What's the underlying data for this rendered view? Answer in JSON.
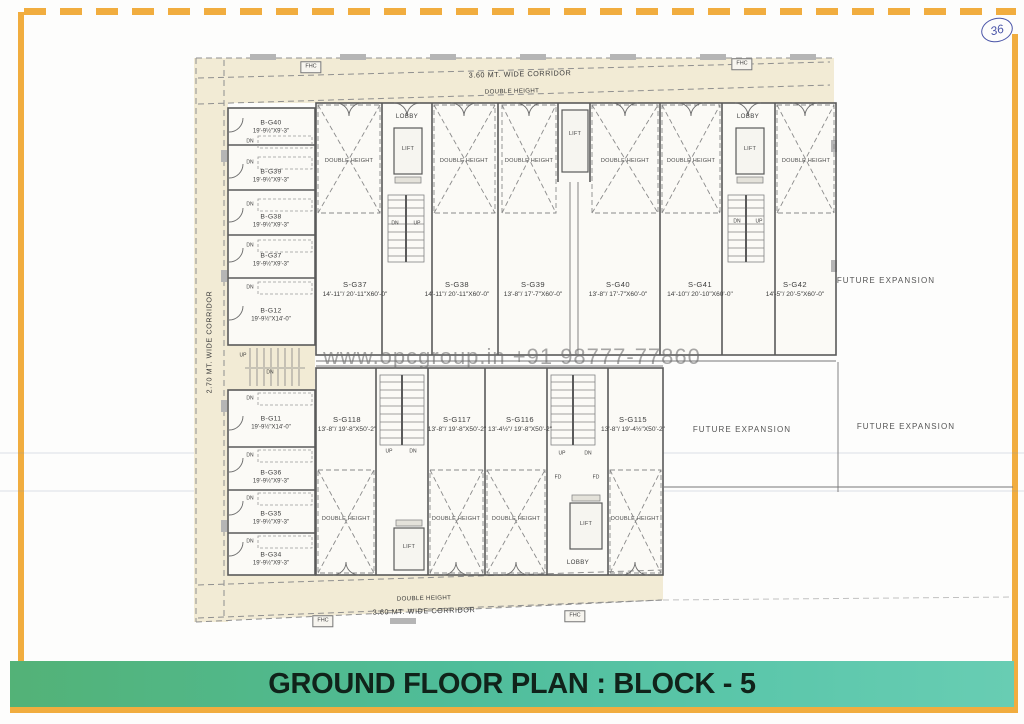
{
  "sheet": {
    "page_number": "36",
    "title": "GROUND FLOOR PLAN : BLOCK - 5",
    "watermark": "www.opcgroup.in +91 98777-77860"
  },
  "labels": {
    "corridor_top": "3.60 MT. WIDE CORRIDOR",
    "corridor_bottom": "3.60 MT. WIDE CORRIDOR",
    "corridor_left": "2.70 MT. WIDE CORRIDOR",
    "double_height": "DOUBLE HEIGHT",
    "future_expansion": "FUTURE EXPANSION",
    "lobby": "LOBBY",
    "lift": "LIFT",
    "up": "UP",
    "dn": "DN",
    "fd": "FD",
    "fhc": "FHC"
  },
  "rooms_left_upper": [
    {
      "id": "B-G40",
      "dims": "19'-9½\"X9'-3\""
    },
    {
      "id": "B-G39",
      "dims": "19'-9½\"X9'-3\""
    },
    {
      "id": "B-G38",
      "dims": "19'-9½\"X9'-3\""
    },
    {
      "id": "B-G37",
      "dims": "19'-9½\"X9'-3\""
    },
    {
      "id": "B-G12",
      "dims": "19'-9½\"X14'-0\""
    }
  ],
  "rooms_left_lower": [
    {
      "id": "B-G11",
      "dims": "19'-9½\"X14'-0\""
    },
    {
      "id": "B-G36",
      "dims": "19'-9½\"X9'-3\""
    },
    {
      "id": "B-G35",
      "dims": "19'-9½\"X9'-3\""
    },
    {
      "id": "B-G34",
      "dims": "19'-9½\"X9'-3\""
    }
  ],
  "units_upper": [
    {
      "id": "S-G37",
      "dims": "14'-11\"/ 20'-11\"X60'-0\""
    },
    {
      "id": "S-G38",
      "dims": "14'-11\"/ 20'-11\"X60'-0\""
    },
    {
      "id": "S-G39",
      "dims": "13'-8\"/ 17'-7\"X60'-0\""
    },
    {
      "id": "S-G40",
      "dims": "13'-8\"/ 17'-7\"X60'-0\""
    },
    {
      "id": "S-G41",
      "dims": "14'-10\"/ 20'-10\"X60'-0\""
    },
    {
      "id": "S-G42",
      "dims": "14'-5\"/ 20'-5\"X60'-0\""
    }
  ],
  "units_lower": [
    {
      "id": "S-G118",
      "dims": "13'-8\"/ 19'-8\"X50'-2\""
    },
    {
      "id": "S-G117",
      "dims": "13'-8\"/ 19'-8\"X50'-2\""
    },
    {
      "id": "S-G116",
      "dims": "13'-4½\"/ 19'-8\"X50'-2\""
    },
    {
      "id": "S-G115",
      "dims": "13'-8\"/ 19'-4½\"X50'-2\""
    }
  ],
  "colors": {
    "frame_orange": "#f1ad3f",
    "titlebar_green_a": "#53b277",
    "titlebar_green_b": "#5cc7ab",
    "corridor_beige": "#f2ebd5",
    "pen_blue": "#4a55a8"
  }
}
